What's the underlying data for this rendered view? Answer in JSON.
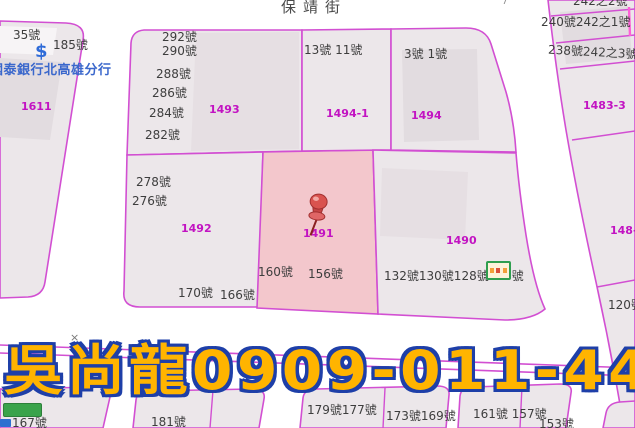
{
  "street": {
    "name": "保靖街"
  },
  "overlay": {
    "text": "吳尚龍0909-011-448"
  },
  "bank": {
    "symbol": "$",
    "name": "國泰銀行北高雄分行"
  },
  "markers": {
    "x_marker": "×",
    "seven_top": "7",
    "seven_road": "7",
    "pin": "red-pushpin",
    "store": "store-sign"
  },
  "parcel_labels": {
    "p1611": "1611",
    "p1493": "1493",
    "p1494_1": "1494-1",
    "p1494": "1494",
    "p1483_3": "1483-3",
    "p1492": "1492",
    "p1491": "1491",
    "p1490": "1490",
    "p148": "148-"
  },
  "house_numbers": {
    "h35": "35號",
    "h185": "185號",
    "h292": "292號",
    "h290": "290號",
    "h288": "288號",
    "h286": "286號",
    "h284": "284號",
    "h282": "282號",
    "h13_11": "13號 11號",
    "h3_1": "3號 1號",
    "h242_2": "242之2號",
    "h240_242_1": "240號242之1號",
    "h238_242_3": "238號242之3號",
    "h278": "278號",
    "h276": "276號",
    "h160": "160號",
    "h156": "156號",
    "h170": "170號",
    "h166": "166號",
    "h132_130_128_126": "132號130號128號126號",
    "h120": "120號",
    "h167": "167號",
    "h181": "181號",
    "h179_177": "179號177號",
    "h173_169": "173號169號",
    "h161_157": "161號 157號",
    "h153": "153號"
  },
  "colors": {
    "boundary_line": "#D24FD2",
    "parcel_fill": "#ECE7EA",
    "building_fill": "#E2DCE0",
    "highlight_fill": "#F3C7CC",
    "parcel_label": "#C213C2",
    "house_number_text": "#3D3D3D",
    "bank_text": "#3A67CC",
    "overlay_text": "#FFB400",
    "overlay_outline": "#1E3FA8",
    "pin_red": "#D9534F",
    "store_green": "#2F9E4F"
  }
}
